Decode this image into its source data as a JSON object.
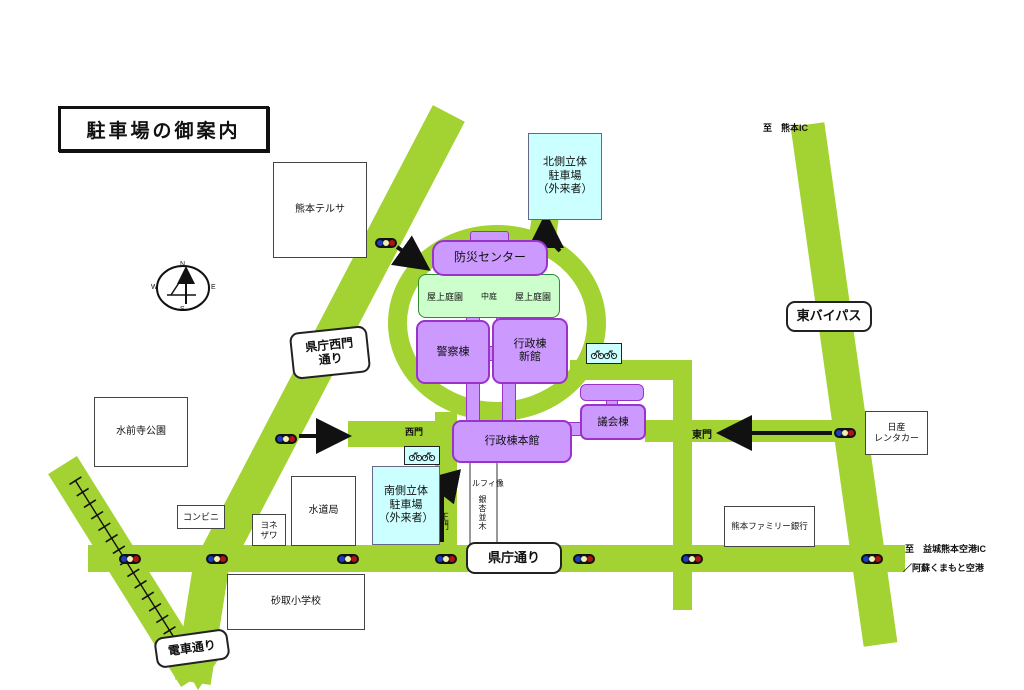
{
  "title": "駐車場の御案内",
  "colors": {
    "road_green": "#a3d233",
    "building_fill": "#cc99ff",
    "building_border": "#9933cc",
    "garden_fill": "#ccffcc",
    "parking_fill": "#ccffff",
    "signal_blue": "#1840c0",
    "signal_yellow": "#f2eeb0",
    "signal_red": "#b01414"
  },
  "compass": {
    "n": "N",
    "e": "E",
    "s": "S",
    "w": "W"
  },
  "roads": {
    "seimon_dori_line1": "県庁西門",
    "seimon_dori_line2": "通り",
    "higashi_bypass": "東バイパス",
    "kencho_dori": "県庁通り",
    "densha_dori": "電車通り"
  },
  "gates": {
    "west": "西門",
    "east": "東門",
    "main": "正門"
  },
  "buildings": {
    "bosai_center": "防災センター",
    "rooftop_garden_left": "屋上庭園",
    "rooftop_garden_right": "屋上庭園",
    "courtyard": "中庭",
    "police": "警察棟",
    "admin_annex_line1": "行政棟",
    "admin_annex_line2": "新館",
    "admin_main": "行政棟本館",
    "assembly": "議会棟"
  },
  "parking": {
    "north_line1": "北側立体",
    "north_line2": "駐車場",
    "north_line3": "（外来者）",
    "south_line1": "南側立体",
    "south_line2": "駐車場",
    "south_line3": "（外来者）"
  },
  "places": {
    "terusa": "熊本テルサ",
    "suizenji_park": "水前寺公園",
    "convenience": "コンビニ",
    "yonezawa_line1": "ヨネ",
    "yonezawa_line2": "ザワ",
    "waterworks": "水道局",
    "sunatori_school": "砂取小学校",
    "family_bank": "熊本ファミリー銀行",
    "nissan_line1": "日産",
    "nissan_line2": "レンタカー"
  },
  "directions": {
    "kumamoto_ic": "至　熊本IC",
    "airport_line1": "至　益城熊本空港IC",
    "airport_line2": "／阿蘇くまもと空港"
  },
  "landmarks": {
    "luffy_statue": "ルフィ像",
    "ginkgo_trees": "銀杏並木"
  }
}
